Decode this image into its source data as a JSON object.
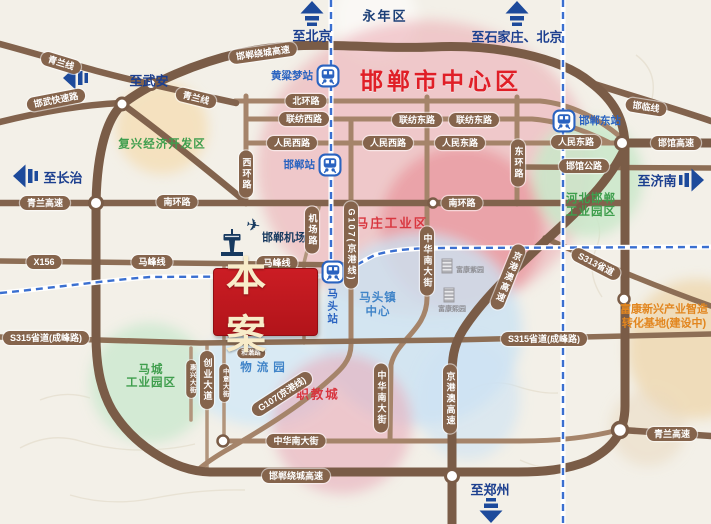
{
  "project": {
    "label": "本案"
  },
  "districts": [
    {
      "id": "yongnian",
      "lines": [
        "永年区"
      ],
      "x": 385,
      "y": 15,
      "cls": "navy"
    },
    {
      "id": "city-center",
      "lines": [
        "邯郸市中心区"
      ],
      "x": 441,
      "y": 79,
      "cls": "title"
    },
    {
      "id": "fuxing-kaifaqu",
      "lines": [
        "复兴经济开发区"
      ],
      "x": 162,
      "y": 145,
      "cls": "green"
    },
    {
      "id": "mazhuang-gongyequ",
      "lines": [
        "马庄工业区"
      ],
      "x": 392,
      "y": 222,
      "cls": "red"
    },
    {
      "id": "hebei-handan-yuanqu",
      "lines": [
        "河北邯郸",
        "工业园区"
      ],
      "x": 591,
      "y": 206,
      "cls": "green"
    },
    {
      "id": "macheng-yuanqu",
      "lines": [
        "马城",
        "工业园区"
      ],
      "x": 151,
      "y": 377,
      "cls": "green"
    },
    {
      "id": "matou-center",
      "lines": [
        "马头镇",
        "中心"
      ],
      "x": 378,
      "y": 306,
      "cls": "blue"
    },
    {
      "id": "wuliuyuan",
      "lines": [
        "物流园"
      ],
      "x": 265,
      "y": 369,
      "cls": "blue sp"
    },
    {
      "id": "zhijiaocheng",
      "lines": [
        "职教城"
      ],
      "x": 318,
      "y": 393,
      "cls": "red"
    },
    {
      "id": "fukang-base",
      "lines": [
        "富康新兴产业智造",
        "转化基地(建设中)"
      ],
      "x": 664,
      "y": 317,
      "cls": "orange"
    }
  ],
  "road_labels": [
    {
      "t": "邯郸绕城高速",
      "x": 263,
      "y": 53,
      "r": -8
    },
    {
      "t": "青兰线",
      "x": 61,
      "y": 63,
      "r": 17
    },
    {
      "t": "邯武快速路",
      "x": 56,
      "y": 100,
      "r": -11
    },
    {
      "t": "青兰线",
      "x": 196,
      "y": 98,
      "r": 14
    },
    {
      "t": "北环路",
      "x": 306,
      "y": 101
    },
    {
      "t": "联纺西路",
      "x": 304,
      "y": 119
    },
    {
      "t": "联纺东路",
      "x": 417,
      "y": 120
    },
    {
      "t": "联纺东路",
      "x": 474,
      "y": 120
    },
    {
      "t": "人民西路",
      "x": 292,
      "y": 143
    },
    {
      "t": "人民西路",
      "x": 388,
      "y": 143
    },
    {
      "t": "人民东路",
      "x": 460,
      "y": 143
    },
    {
      "t": "人民东路",
      "x": 576,
      "y": 142
    },
    {
      "t": "邯临线",
      "x": 646,
      "y": 107,
      "r": 9
    },
    {
      "t": "邯馆高速",
      "x": 676,
      "y": 143
    },
    {
      "t": "邯馆公路",
      "x": 584,
      "y": 166
    },
    {
      "t": "南环路",
      "x": 177,
      "y": 202
    },
    {
      "t": "南环路",
      "x": 462,
      "y": 203
    },
    {
      "t": "青兰高速",
      "x": 45,
      "y": 203
    },
    {
      "t": "X156",
      "x": 44,
      "y": 262
    },
    {
      "t": "马峰线",
      "x": 152,
      "y": 262
    },
    {
      "t": "马峰线",
      "x": 277,
      "y": 263
    },
    {
      "t": "S315省道(成峰路)",
      "x": 46,
      "y": 338
    },
    {
      "t": "S315省道(成峰路)",
      "x": 544,
      "y": 339
    },
    {
      "t": "S313省道",
      "x": 596,
      "y": 264,
      "r": 27
    },
    {
      "t": "中华南大街",
      "x": 296,
      "y": 441
    },
    {
      "t": "邯郸绕城高速",
      "x": 296,
      "y": 476
    },
    {
      "t": "青兰高速",
      "x": 672,
      "y": 434
    },
    {
      "t": "G107(京港线)",
      "x": 282,
      "y": 394,
      "r": -33
    },
    {
      "t": "和谐路",
      "x": 251,
      "y": 353,
      "s": 1
    },
    {
      "t": "西环路",
      "x": 246,
      "y": 174,
      "v": 1
    },
    {
      "t": "东环路",
      "x": 518,
      "y": 163,
      "v": 1
    },
    {
      "t": "机场路",
      "x": 312,
      "y": 230,
      "v": 1
    },
    {
      "t": "G107(京港线)",
      "x": 351,
      "y": 245,
      "v": 1
    },
    {
      "t": "中华南大街",
      "x": 427,
      "y": 261,
      "v": 1
    },
    {
      "t": "中华南大街",
      "x": 381,
      "y": 398,
      "v": 1
    },
    {
      "t": "京港澳高速",
      "x": 450,
      "y": 399,
      "v": 1
    },
    {
      "t": "京港澳高速",
      "x": 508,
      "y": 277,
      "v": 1,
      "r": 22
    },
    {
      "t": "创业大道",
      "x": 207,
      "y": 380,
      "v": 1
    },
    {
      "t": "惠兴大街",
      "x": 191,
      "y": 379,
      "v": 1,
      "s": 1
    },
    {
      "t": "中意大街",
      "x": 224,
      "y": 383,
      "v": 1,
      "s": 1
    },
    {
      "t": "中意大街",
      "x": 225,
      "y": 307,
      "v": 1,
      "s": 1
    },
    {
      "t": "和谐大道",
      "x": 304,
      "y": 312,
      "v": 1,
      "s": 1
    }
  ],
  "stations": [
    {
      "id": "huangliangmeng",
      "label": "黄粱梦站",
      "x": 328,
      "y": 76,
      "side": "left"
    },
    {
      "id": "handan",
      "label": "邯郸站",
      "x": 330,
      "y": 165,
      "side": "left"
    },
    {
      "id": "matou",
      "label": "马头站",
      "x": 333,
      "y": 272,
      "side": "below"
    },
    {
      "id": "handandong",
      "label": "邯郸东站",
      "lines": [
        "邯郸",
        "东站"
      ],
      "x": 564,
      "y": 121,
      "side": "right"
    }
  ],
  "airport": {
    "id": "handan-airport",
    "lines": [
      "邯郸",
      "机场"
    ],
    "x": 262,
    "y": 238
  },
  "directions": [
    {
      "id": "beijing",
      "label": "至北京",
      "dir": "up",
      "x": 312,
      "y": 14,
      "lx": 312,
      "ly": 35
    },
    {
      "id": "shijiazhuang-beijing",
      "label": "至石家庄、北京",
      "dir": "up",
      "x": 517,
      "y": 14,
      "lx": 517,
      "ly": 36
    },
    {
      "id": "wuan",
      "label": "至武安",
      "dir": "left",
      "x": 76,
      "y": 78,
      "lx": 149,
      "ly": 80
    },
    {
      "id": "changzhi",
      "label": "至长治",
      "dir": "left",
      "x": 26,
      "y": 176,
      "lx": 63,
      "ly": 177
    },
    {
      "id": "jinan",
      "label": "至济南",
      "dir": "right",
      "x": 691,
      "y": 180,
      "lx": 657,
      "ly": 180
    },
    {
      "id": "zhengzhou",
      "label": "至郑州",
      "dir": "down",
      "x": 491,
      "y": 510,
      "lx": 490,
      "ly": 489
    }
  ],
  "pois": [
    {
      "id": "fukang-ziyuan",
      "label": "富康紫园",
      "bx": 447,
      "by": 266,
      "lx": 470,
      "ly": 270
    },
    {
      "id": "fukang-xiyuan",
      "label": "富康熙园",
      "bx": 449,
      "by": 295,
      "lx": 452,
      "ly": 309
    }
  ],
  "colors": {
    "road_brown": "#7a5c47",
    "capsule_brown": "#85644c",
    "railway_blue": "#3a6fd0",
    "title_red": "#e01f27",
    "project_red": "#c01920",
    "direction_navy": "#1c3f8f"
  }
}
